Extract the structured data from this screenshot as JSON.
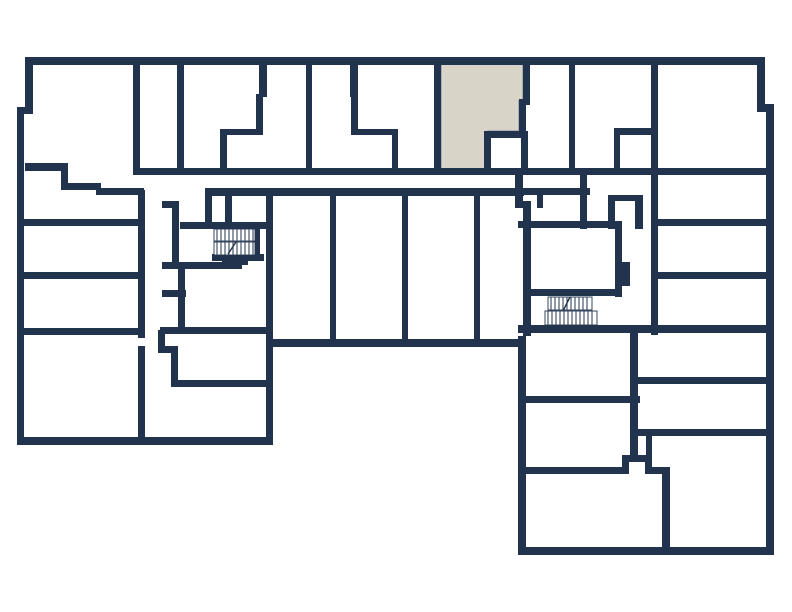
{
  "floor_plan": {
    "canvas": {
      "width": 792,
      "height": 612,
      "background": "#ffffff"
    },
    "colors": {
      "wall": "#22334d",
      "room": "#ffffff",
      "highlight": "#d9d4c8",
      "highlight_outline": "#97a2b4"
    },
    "highlighted_unit": {
      "polygon": [
        [
          441,
          63
        ],
        [
          523,
          63
        ],
        [
          523,
          101
        ],
        [
          519,
          101
        ],
        [
          519,
          131
        ],
        [
          488,
          131
        ],
        [
          488,
          172
        ],
        [
          441,
          172
        ]
      ]
    },
    "walls": [
      [
        25,
        57,
        740,
        8
      ],
      [
        757,
        57,
        8,
        55
      ],
      [
        757,
        104,
        17,
        8
      ],
      [
        766,
        104,
        8,
        451
      ],
      [
        518,
        547,
        256,
        8
      ],
      [
        515,
        175,
        8,
        33
      ],
      [
        515,
        201,
        16,
        7
      ],
      [
        523,
        201,
        8,
        135
      ],
      [
        518,
        336,
        8,
        219
      ],
      [
        266,
        339,
        258,
        8
      ],
      [
        266,
        339,
        7,
        106
      ],
      [
        17,
        437,
        256,
        8
      ],
      [
        17,
        107,
        7,
        338
      ],
      [
        17,
        107,
        16,
        7
      ],
      [
        25,
        57,
        8,
        57
      ],
      [
        133,
        168,
        635,
        7
      ],
      [
        133,
        65,
        7,
        110
      ],
      [
        177,
        65,
        7,
        110
      ],
      [
        306,
        65,
        6,
        110
      ],
      [
        259,
        65,
        8,
        32
      ],
      [
        256,
        94,
        7,
        41
      ],
      [
        220,
        129,
        43,
        6
      ],
      [
        220,
        129,
        7,
        41
      ],
      [
        350,
        65,
        8,
        32
      ],
      [
        351,
        94,
        7,
        41
      ],
      [
        351,
        129,
        47,
        6
      ],
      [
        392,
        129,
        6,
        41
      ],
      [
        434,
        65,
        7,
        107
      ],
      [
        523,
        65,
        7,
        40
      ],
      [
        519,
        99,
        7,
        36
      ],
      [
        521,
        131,
        7,
        41
      ],
      [
        484,
        131,
        43,
        7
      ],
      [
        484,
        131,
        7,
        41
      ],
      [
        569,
        65,
        6,
        110
      ],
      [
        651,
        65,
        7,
        270
      ],
      [
        614,
        128,
        44,
        7
      ],
      [
        614,
        128,
        6,
        42
      ],
      [
        25,
        163,
        43,
        8
      ],
      [
        61,
        163,
        7,
        27
      ],
      [
        61,
        183,
        40,
        7
      ],
      [
        96,
        188,
        48,
        7
      ],
      [
        138,
        190,
        7,
        148
      ],
      [
        138,
        346,
        7,
        99
      ],
      [
        24,
        219,
        118,
        7
      ],
      [
        24,
        272,
        118,
        7
      ],
      [
        24,
        328,
        118,
        7
      ],
      [
        162,
        201,
        17,
        7
      ],
      [
        172,
        201,
        7,
        68
      ],
      [
        178,
        263,
        7,
        64
      ],
      [
        162,
        290,
        24,
        7
      ],
      [
        160,
        327,
        113,
        7
      ],
      [
        158,
        330,
        7,
        23
      ],
      [
        158,
        346,
        20,
        7
      ],
      [
        171,
        346,
        7,
        41
      ],
      [
        171,
        380,
        99,
        7
      ],
      [
        205,
        188,
        7,
        41
      ],
      [
        225,
        188,
        7,
        41
      ],
      [
        180,
        222,
        86,
        7
      ],
      [
        253,
        227,
        7,
        34
      ],
      [
        212,
        254,
        52,
        7
      ],
      [
        222,
        258,
        26,
        7
      ],
      [
        162,
        262,
        80,
        7
      ],
      [
        205,
        188,
        319,
        8
      ],
      [
        266,
        188,
        7,
        159
      ],
      [
        330,
        196,
        6,
        147
      ],
      [
        402,
        196,
        6,
        147
      ],
      [
        474,
        196,
        6,
        147
      ],
      [
        518,
        188,
        72,
        7
      ],
      [
        537,
        195,
        6,
        13
      ],
      [
        580,
        175,
        7,
        54
      ],
      [
        608,
        195,
        7,
        34
      ],
      [
        608,
        195,
        34,
        6
      ],
      [
        635,
        195,
        8,
        34
      ],
      [
        518,
        221,
        97,
        7
      ],
      [
        615,
        221,
        7,
        76
      ],
      [
        622,
        262,
        8,
        24
      ],
      [
        523,
        289,
        99,
        7
      ],
      [
        518,
        325,
        250,
        8
      ],
      [
        651,
        219,
        117,
        7
      ],
      [
        651,
        272,
        117,
        7
      ],
      [
        630,
        325,
        8,
        133
      ],
      [
        638,
        377,
        130,
        7
      ],
      [
        638,
        429,
        130,
        7
      ],
      [
        518,
        396,
        122,
        7
      ],
      [
        518,
        467,
        111,
        7
      ],
      [
        622,
        455,
        7,
        19
      ],
      [
        622,
        455,
        30,
        7
      ],
      [
        645,
        455,
        7,
        19
      ],
      [
        645,
        467,
        25,
        7
      ],
      [
        662,
        467,
        8,
        86
      ],
      [
        646,
        433,
        6,
        24
      ]
    ],
    "stairs": [
      {
        "name": "stairs-left",
        "tread_gap": 4,
        "flights": [
          [
            214,
            229,
            41,
            12
          ],
          [
            214,
            242,
            41,
            13
          ]
        ],
        "break_mark": [
          228,
          254,
          236,
          242
        ]
      },
      {
        "name": "stairs-right",
        "tread_gap": 4,
        "flights": [
          [
            548,
            297,
            44,
            13
          ],
          [
            545,
            311,
            52,
            14
          ]
        ],
        "break_mark": [
          563,
          311,
          570,
          297
        ]
      }
    ]
  }
}
